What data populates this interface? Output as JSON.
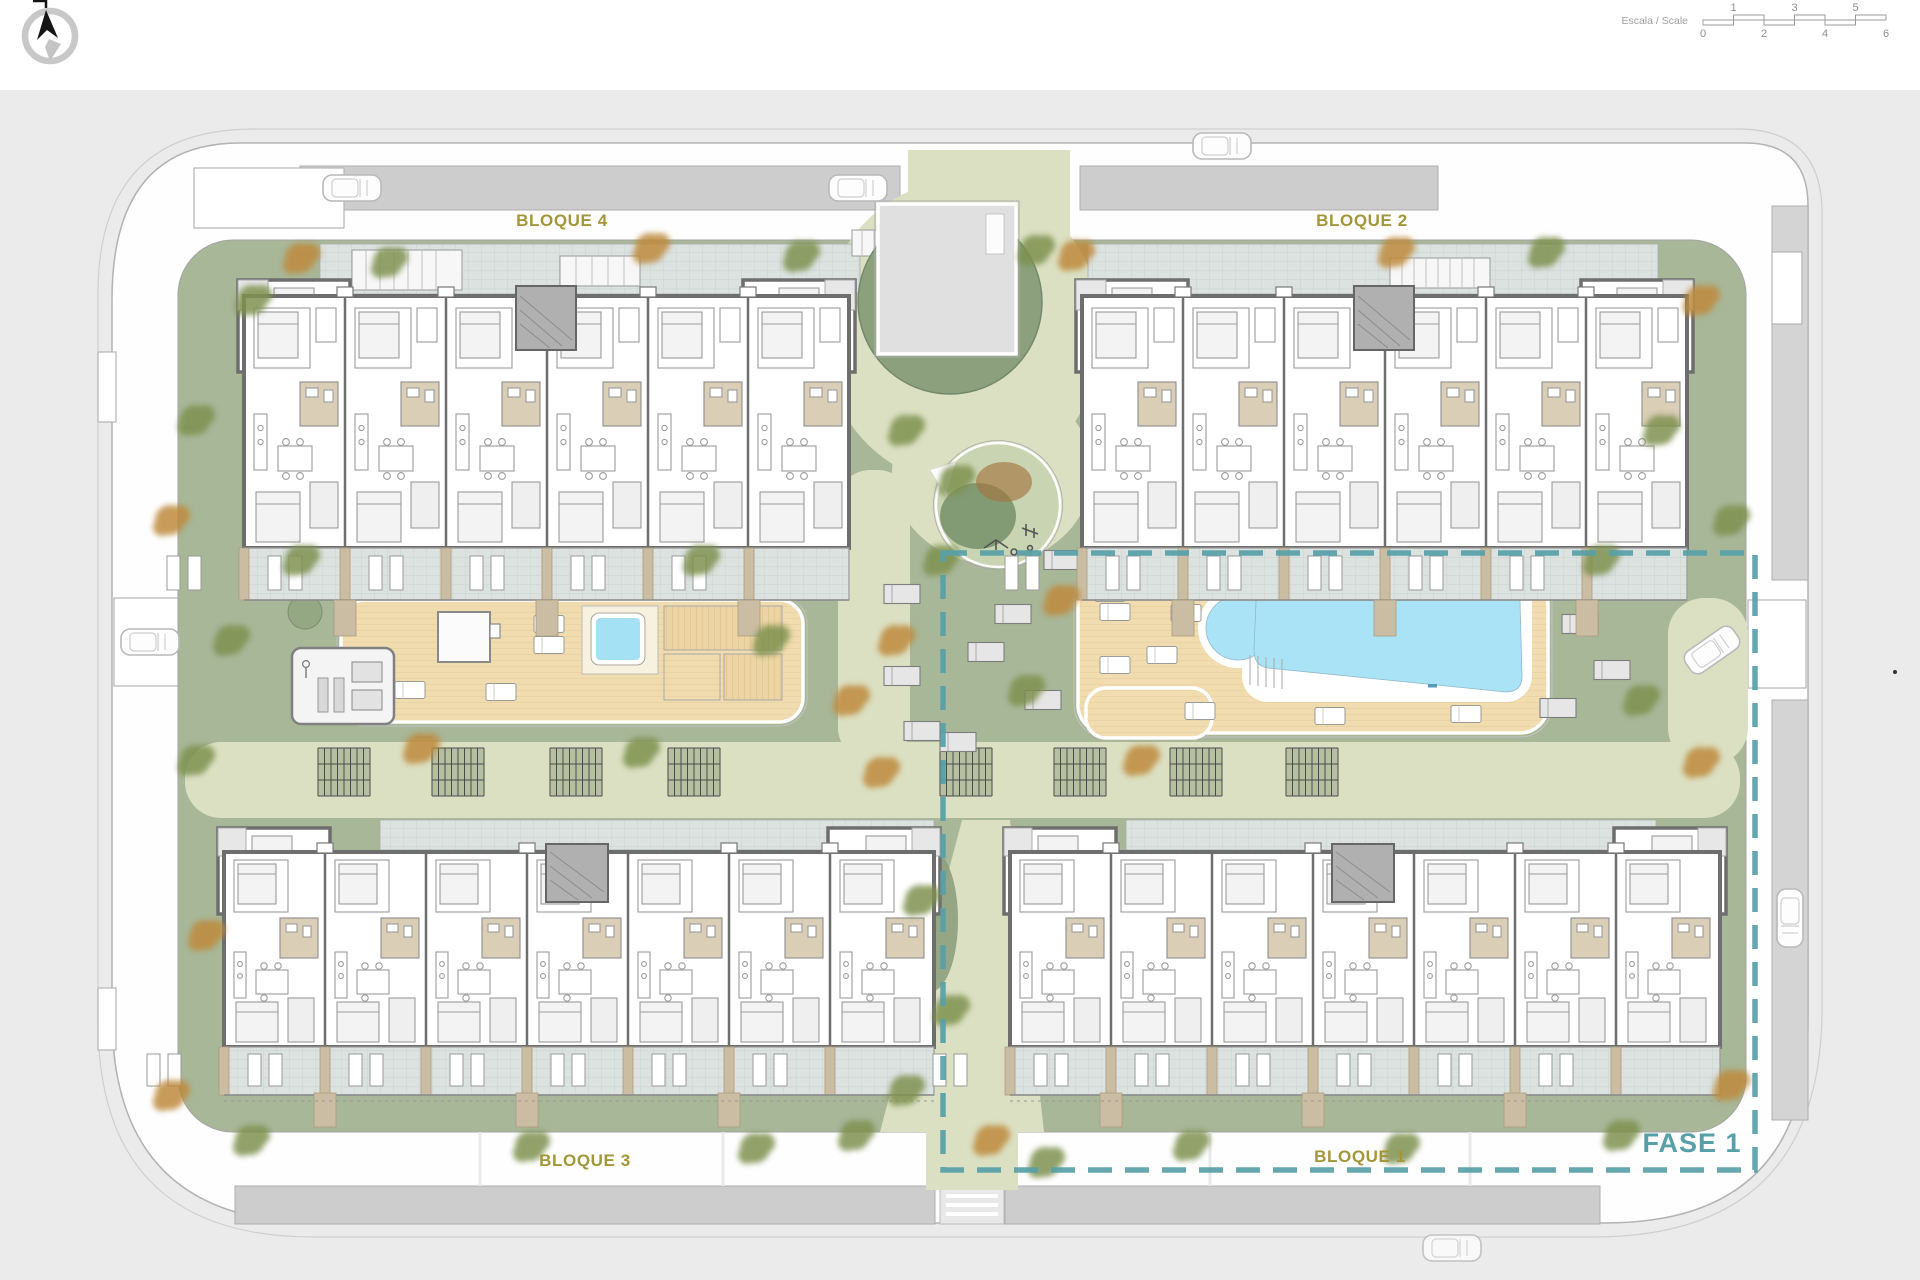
{
  "compass": {
    "name": "north-arrow"
  },
  "scalebar": {
    "label": "Escala / Scale",
    "top_ticks": [
      "1",
      "3",
      "5"
    ],
    "bottom_ticks": [
      "0",
      "2",
      "4",
      "6"
    ]
  },
  "blocks": {
    "b1": "BLOQUE 1",
    "b2": "BLOQUE 2",
    "b3": "BLOQUE 3",
    "b4": "BLOQUE 4"
  },
  "phase": {
    "label": "FASE 1"
  },
  "colors": {
    "block_label": "#A39638",
    "phase_teal": "#57A0A8",
    "pool_blue": "#ABE3F6",
    "deck_wood": "#F1DCB0",
    "lawn_green": "#A8B798",
    "path_olive": "#DBE0C2",
    "dark_green": "#8CA07D",
    "road": "#FEFEFE",
    "sidewalk": "#CDCDCD",
    "terrace_tile": "#DBE2E0",
    "bathroom_beige": "#DACEB6"
  }
}
